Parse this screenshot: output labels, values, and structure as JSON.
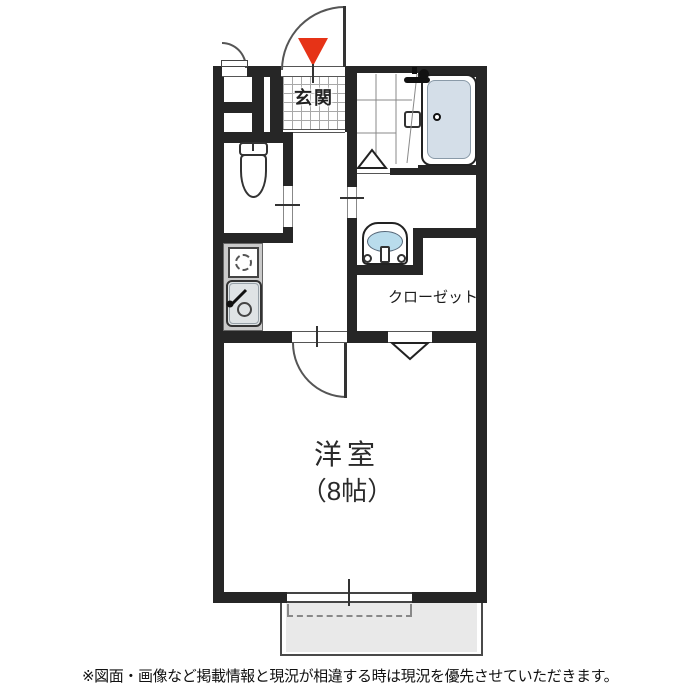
{
  "plan": {
    "labels": {
      "entrance": "玄関",
      "closet": "クローゼット",
      "room_name": "洋室",
      "room_size": "（8帖）"
    },
    "disclaimer": "※図面・画像など掲載情報と現況が相違する時は現況を優先させていただきます。",
    "icons": [
      "entrance-marker-icon",
      "toilet-icon",
      "bathtub-icon",
      "bath-faucet-icon",
      "washbasin-icon",
      "stove-icon",
      "kitchen-sink-icon",
      "folding-door-icon",
      "door-swing-arc",
      "sliding-window",
      "balcony"
    ]
  },
  "colors": {
    "wall": "#262626",
    "line": "#555555",
    "marker-red": "#e63317",
    "bathtub-fill": "#d4dee8",
    "basin-fill": "#b9dcec",
    "balcony-fill": "#e9e9e9",
    "counter-fill": "#cacaca",
    "sink-fill": "#dfe3e5",
    "tile-line": "#a8a8a8",
    "text": "#1f1f1f"
  }
}
